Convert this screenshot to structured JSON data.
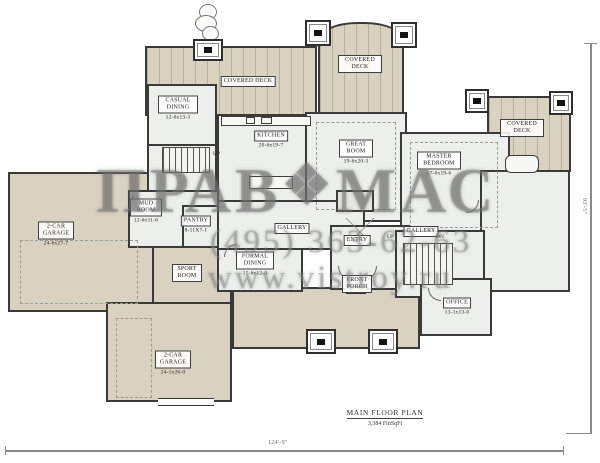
{
  "plan": {
    "title": "MAIN FLOOR PLAN",
    "area": "3,384 FinSqFt",
    "width_dim": "124'-9\"",
    "height_dim": "93'-5\""
  },
  "watermark": {
    "logo_left": "ПРАВ",
    "logo_emblem": "❖",
    "logo_right": "МАС",
    "phone": "(495) 363-62-63",
    "website": "www.vistroy.ru"
  },
  "rooms": {
    "covered_deck_nw": {
      "name": "COVERED DECK"
    },
    "covered_deck_n": {
      "name": "COVERED DECK"
    },
    "covered_deck_e": {
      "name": "COVERED DECK"
    },
    "casual_dining": {
      "name": "CASUAL DINING",
      "dims": "12-6x13-3"
    },
    "kitchen": {
      "name": "KITCHEN",
      "dims": "20-6x19-7"
    },
    "great_room": {
      "name": "GREAT ROOM",
      "dims": "19-6x20-3"
    },
    "master_bedroom": {
      "name": "MASTER BEDROOM",
      "dims": "17-0x19-6"
    },
    "mud_room": {
      "name": "MUD ROOM",
      "dims": "12-6x11-6"
    },
    "pantry": {
      "name": "PANTRY",
      "dims": "8-11X7-1"
    },
    "gallery_w": {
      "name": "GALLERY"
    },
    "entry": {
      "name": "ENTRY"
    },
    "gallery_e": {
      "name": "GALLERY"
    },
    "formal_dining": {
      "name": "FORMAL DINING",
      "dims": "15-6x12-0"
    },
    "sport_room": {
      "name": "SPORT ROOM"
    },
    "front_porch": {
      "name": "FRONT PORCH"
    },
    "office": {
      "name": "OFFICE",
      "dims": "13-1x13-0"
    },
    "garage_w": {
      "name": "2-CAR GARAGE",
      "dims": "24-6x27-7"
    },
    "garage_s": {
      "name": "2-CAR GARAGE",
      "dims": "24-1x26-0"
    }
  },
  "stairs": {
    "up_west": "UP",
    "up_east": "UP",
    "down_east": "DN"
  }
}
